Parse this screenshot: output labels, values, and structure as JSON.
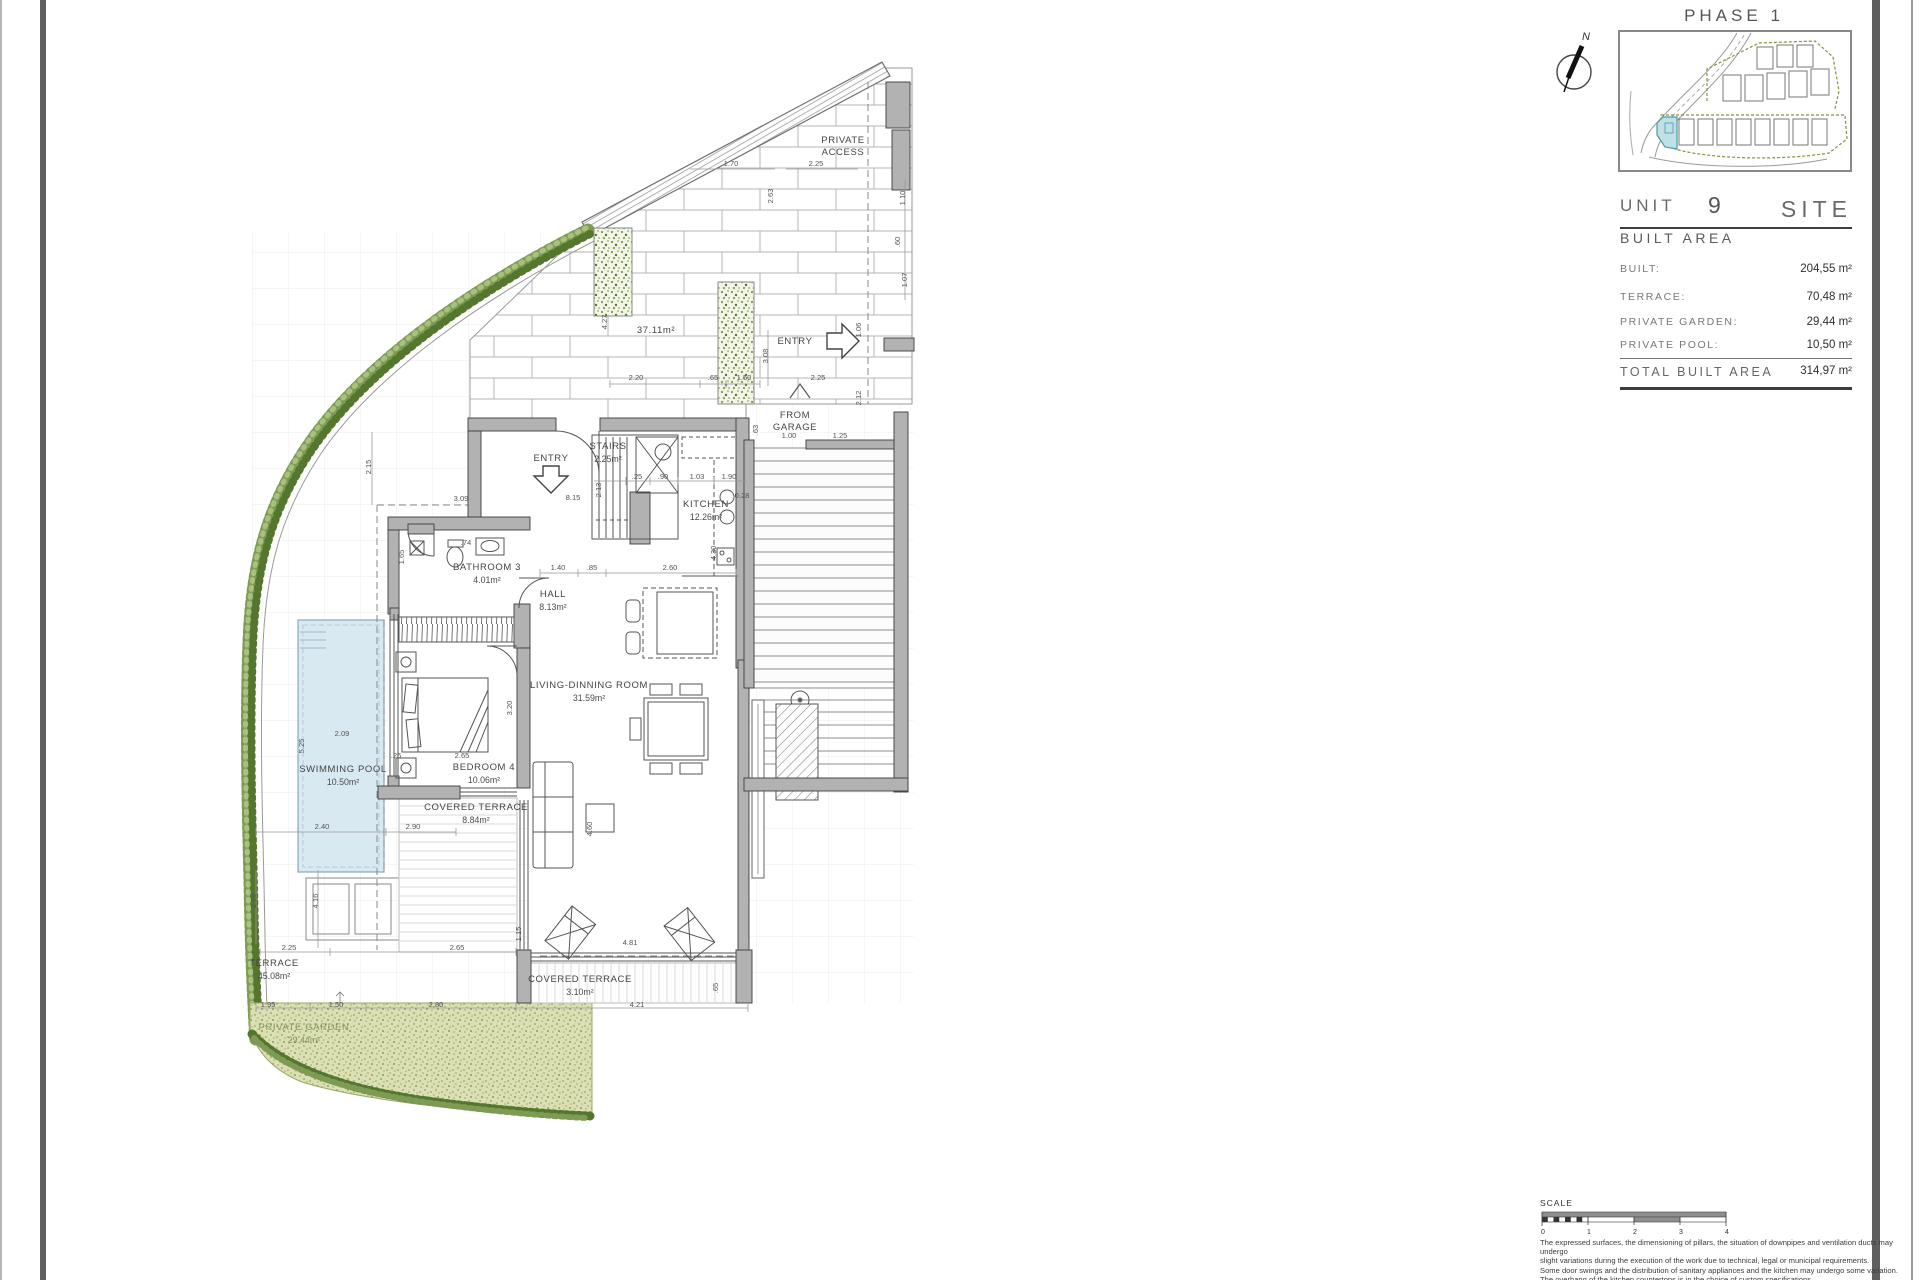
{
  "sheet": {
    "phase_title": "PHASE 1",
    "compass_letter": "N",
    "unit_label": "UNIT",
    "unit_number": "9",
    "site_label": "SITE",
    "built_area_title": "BUILT AREA",
    "area_rows": [
      {
        "label": "BUILT:",
        "value": "204,55 m²"
      },
      {
        "label": "TERRACE:",
        "value": "70,48 m²"
      },
      {
        "label": "PRIVATE GARDEN:",
        "value": "29,44 m²"
      },
      {
        "label": "PRIVATE POOL:",
        "value": "10,50 m²"
      }
    ],
    "total_row": {
      "label": "TOTAL BUILT AREA",
      "value": "314,97 m²"
    },
    "scale": {
      "label": "SCALE",
      "ticks": [
        "0",
        "1",
        "2",
        "3",
        "4"
      ]
    },
    "disclaimer_lines": [
      "The expressed surfaces, the dimensioning of pillars, the situation of downpipes and ventilation ducts may undergo",
      "slight variations during the execution of the work due to technical, legal or municipal requirements.",
      "Some door swings and the distribution of sanitary appliances and the kitchen may undergo some variation.",
      "The overhang of the kitchen countertops is in the choice of custom specifications.",
      "The furniture is merely informative and the materials will be those represented in the specifications."
    ]
  },
  "plan": {
    "rooms": [
      {
        "name": "STAIRS",
        "area": "2.25m²",
        "x": 608,
        "y": 449
      },
      {
        "name": "KITCHEN",
        "area": "12.26m²",
        "x": 706,
        "y": 507
      },
      {
        "name": "BATHROOM 3",
        "area": "4.01m²",
        "x": 487,
        "y": 570
      },
      {
        "name": "HALL",
        "area": "8.13m²",
        "x": 553,
        "y": 597
      },
      {
        "name": "LIVING-DINNING ROOM",
        "area": "31.59m²",
        "x": 589,
        "y": 688
      },
      {
        "name": "BEDROOM 4",
        "area": "10.06m²",
        "x": 484,
        "y": 770
      },
      {
        "name": "COVERED TERRACE",
        "area": "8.84m²",
        "x": 476,
        "y": 810
      },
      {
        "name": "SWIMMING POOL",
        "area": "10.50m²",
        "x": 343,
        "y": 772
      },
      {
        "name": "TERRACE",
        "area": "45.08m²",
        "x": 274,
        "y": 966
      },
      {
        "name": "COVERED TERRACE",
        "area": "3.10m²",
        "x": 580,
        "y": 982
      }
    ],
    "garden_label": {
      "name": "PRIVATE GARDEN",
      "area": "29.44m²",
      "x": 304,
      "y": 1030
    },
    "annotations": [
      {
        "text": "PRIVATE",
        "x": 843,
        "y": 143
      },
      {
        "text": "ACCESS",
        "x": 843,
        "y": 155
      },
      {
        "text": "ENTRY",
        "x": 551,
        "y": 461
      },
      {
        "text": "ENTRY",
        "x": 795,
        "y": 344
      },
      {
        "text": "FROM",
        "x": 795,
        "y": 418
      },
      {
        "text": "GARAGE",
        "x": 795,
        "y": 430
      },
      {
        "text": "37.11m²",
        "x": 656,
        "y": 333
      }
    ],
    "dimensions": [
      {
        "t": "1.70",
        "x": 731,
        "y": 166,
        "r": 0
      },
      {
        "t": "2.25",
        "x": 816,
        "y": 166,
        "r": 0
      },
      {
        "t": "1.10",
        "x": 905,
        "y": 198,
        "r": -90
      },
      {
        "t": ".60",
        "x": 900,
        "y": 242,
        "r": -90
      },
      {
        "t": "1.07",
        "x": 907,
        "y": 280,
        "r": -90
      },
      {
        "t": "2.63",
        "x": 773,
        "y": 196,
        "r": -90
      },
      {
        "t": "4.27",
        "x": 607,
        "y": 322,
        "r": -90
      },
      {
        "t": "2.20",
        "x": 636,
        "y": 380,
        "r": 0
      },
      {
        "t": ".65",
        "x": 713,
        "y": 380,
        "r": 0
      },
      {
        "t": "1.50",
        "x": 744,
        "y": 380,
        "r": 0
      },
      {
        "t": "3.08",
        "x": 768,
        "y": 356,
        "r": -90
      },
      {
        "t": "1.06",
        "x": 861,
        "y": 330,
        "r": -90
      },
      {
        "t": "2.25",
        "x": 818,
        "y": 380,
        "r": 0
      },
      {
        "t": "2.12",
        "x": 861,
        "y": 398,
        "r": -90
      },
      {
        "t": "1.00",
        "x": 789,
        "y": 438,
        "r": 0
      },
      {
        "t": "1.25",
        "x": 840,
        "y": 438,
        "r": 0
      },
      {
        "t": ".63",
        "x": 758,
        "y": 430,
        "r": -90
      },
      {
        "t": "2.15",
        "x": 371,
        "y": 467,
        "r": -90
      },
      {
        "t": "3.09",
        "x": 461,
        "y": 501,
        "r": 0
      },
      {
        "t": "8.15",
        "x": 573,
        "y": 500,
        "r": 0
      },
      {
        "t": "2.13",
        "x": 601,
        "y": 490,
        "r": -90
      },
      {
        "t": ".25",
        "x": 637,
        "y": 479,
        "r": 0
      },
      {
        "t": ".90",
        "x": 663,
        "y": 479,
        "r": 0
      },
      {
        "t": "1.03",
        "x": 697,
        "y": 479,
        "r": 0
      },
      {
        "t": "1.90",
        "x": 729,
        "y": 479,
        "r": 0
      },
      {
        "t": "0.28",
        "x": 742,
        "y": 498,
        "r": 0
      },
      {
        "t": "4.30",
        "x": 716,
        "y": 553,
        "r": -90
      },
      {
        "t": "1.40",
        "x": 558,
        "y": 570,
        "r": 0
      },
      {
        "t": ".85",
        "x": 592,
        "y": 570,
        "r": 0
      },
      {
        "t": "2.60",
        "x": 670,
        "y": 570,
        "r": 0
      },
      {
        "t": "1.65",
        "x": 404,
        "y": 557,
        "r": -90
      },
      {
        "t": ".74",
        "x": 466,
        "y": 545,
        "r": 0
      },
      {
        "t": "3.20",
        "x": 512,
        "y": 708,
        "r": -90
      },
      {
        "t": "2.65",
        "x": 462,
        "y": 758,
        "r": 0
      },
      {
        "t": ".26",
        "x": 396,
        "y": 758,
        "r": 0
      },
      {
        "t": "5.25",
        "x": 304,
        "y": 746,
        "r": -90
      },
      {
        "t": "2.09",
        "x": 342,
        "y": 736,
        "r": 0
      },
      {
        "t": "2.40",
        "x": 322,
        "y": 829,
        "r": 0
      },
      {
        "t": "2.90",
        "x": 413,
        "y": 829,
        "r": 0
      },
      {
        "t": "4.60",
        "x": 592,
        "y": 829,
        "r": -90
      },
      {
        "t": "1.69",
        "x": 256,
        "y": 901,
        "r": -90
      },
      {
        "t": "4.16",
        "x": 318,
        "y": 901,
        "r": -90
      },
      {
        "t": "2.25",
        "x": 289,
        "y": 950,
        "r": 0
      },
      {
        "t": "2.65",
        "x": 457,
        "y": 950,
        "r": 0
      },
      {
        "t": "1.15",
        "x": 521,
        "y": 934,
        "r": -90
      },
      {
        "t": "4.81",
        "x": 630,
        "y": 945,
        "r": 0
      },
      {
        "t": ".65",
        "x": 718,
        "y": 988,
        "r": -90
      },
      {
        "t": "1.95",
        "x": 268,
        "y": 1007,
        "r": 0
      },
      {
        "t": "1.50",
        "x": 336,
        "y": 1007,
        "r": 0
      },
      {
        "t": "2.80",
        "x": 436,
        "y": 1007,
        "r": 0
      },
      {
        "t": "4.21",
        "x": 637,
        "y": 1007,
        "r": 0
      }
    ]
  },
  "colors": {
    "wall": "#b2b2b2",
    "wall_edge": "#3c3c3c",
    "pool_fill": "#d9e9f2",
    "pool_edge": "#85aabd",
    "grass_fill": "#dbe0b4",
    "shrub_green": "#6d8d41",
    "highlight_unit": "#bfe0e4",
    "line_gray": "#777777"
  }
}
